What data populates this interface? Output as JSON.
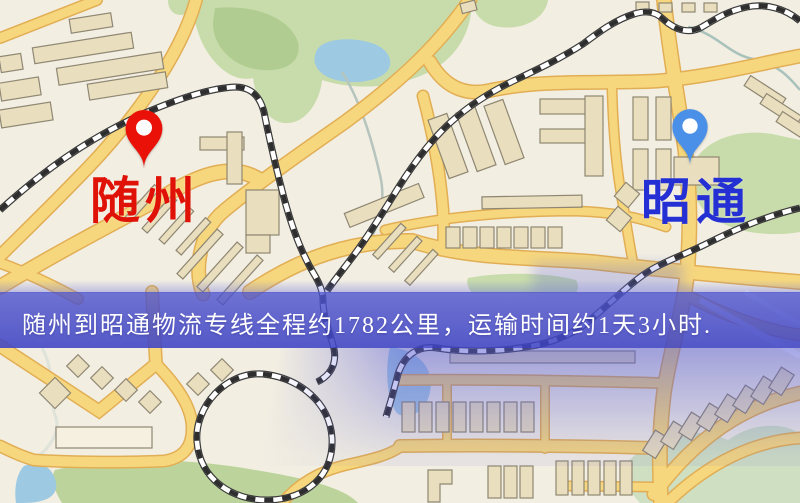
{
  "map": {
    "origin": {
      "label": "随州",
      "marker": "red-pin",
      "marker_color": "#ea1208",
      "label_color": "#e01208"
    },
    "destination": {
      "label": "昭通",
      "marker": "blue-pin",
      "marker_color": "#4b90e8",
      "label_color": "#2530d4"
    },
    "banner": {
      "text": "随州到昭通物流专线全程约1782公里，运输时间约1天3小时.",
      "background_color": "#4e53cc",
      "text_color": "#ffffff"
    },
    "palette": {
      "map_background": "#f2eee2",
      "road_fill": "#f6d77e",
      "road_casing": "#e2ae54",
      "park_green": "#c8dcab",
      "water_blue": "#9dc9e2",
      "building_fill": "#e9debd",
      "railway_dark": "#2e2e2e"
    }
  }
}
